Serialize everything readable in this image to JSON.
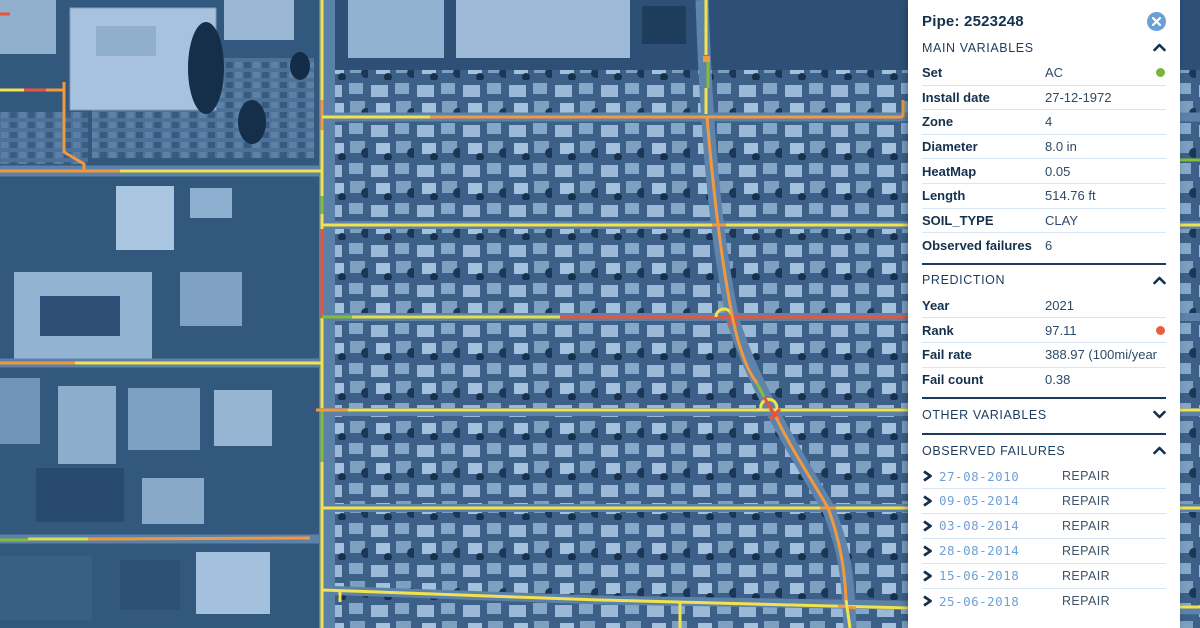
{
  "panel": {
    "title": "Pipe: 2523248",
    "sections": {
      "main_variables": {
        "label": "MAIN VARIABLES",
        "state": "expanded",
        "rows": [
          {
            "label": "Set",
            "value": "AC",
            "dot_color": "#7db23f"
          },
          {
            "label": "Install date",
            "value": "27-12-1972"
          },
          {
            "label": "Zone",
            "value": "4"
          },
          {
            "label": "Diameter",
            "value": "8.0 in"
          },
          {
            "label": "HeatMap",
            "value": "0.05"
          },
          {
            "label": "Length",
            "value": "514.76 ft"
          },
          {
            "label": "SOIL_TYPE",
            "value": "CLAY"
          },
          {
            "label": "Observed failures",
            "value": "6"
          }
        ]
      },
      "prediction": {
        "label": "PREDICTION",
        "state": "expanded",
        "rows": [
          {
            "label": "Year",
            "value": "2021"
          },
          {
            "label": "Rank",
            "value": "97.11",
            "dot_color": "#e85f3d"
          },
          {
            "label": "Fail rate",
            "value": "388.97 (100mi/year"
          },
          {
            "label": "Fail count",
            "value": "0.38"
          }
        ]
      },
      "other_variables": {
        "label": "OTHER VARIABLES",
        "state": "collapsed"
      },
      "observed_failures": {
        "label": "OBSERVED FAILURES",
        "state": "expanded",
        "rows": [
          {
            "date": "27-08-2010",
            "type": "REPAIR"
          },
          {
            "date": "09-05-2014",
            "type": "REPAIR"
          },
          {
            "date": "03-08-2014",
            "type": "REPAIR"
          },
          {
            "date": "28-08-2014",
            "type": "REPAIR"
          },
          {
            "date": "15-06-2018",
            "type": "REPAIR"
          },
          {
            "date": "25-06-2018",
            "type": "REPAIR"
          }
        ]
      }
    }
  },
  "map": {
    "type": "satellite-with-pipe-network",
    "pipe_colors": {
      "yellow": "#f2e24d",
      "orange": "#f0993f",
      "red": "#e8553a",
      "green": "#86bb3a"
    },
    "icons": [
      "close-icon",
      "chevron-up-icon",
      "chevron-down-icon",
      "chevron-right-icon",
      "status-dot-green",
      "status-dot-red"
    ]
  }
}
